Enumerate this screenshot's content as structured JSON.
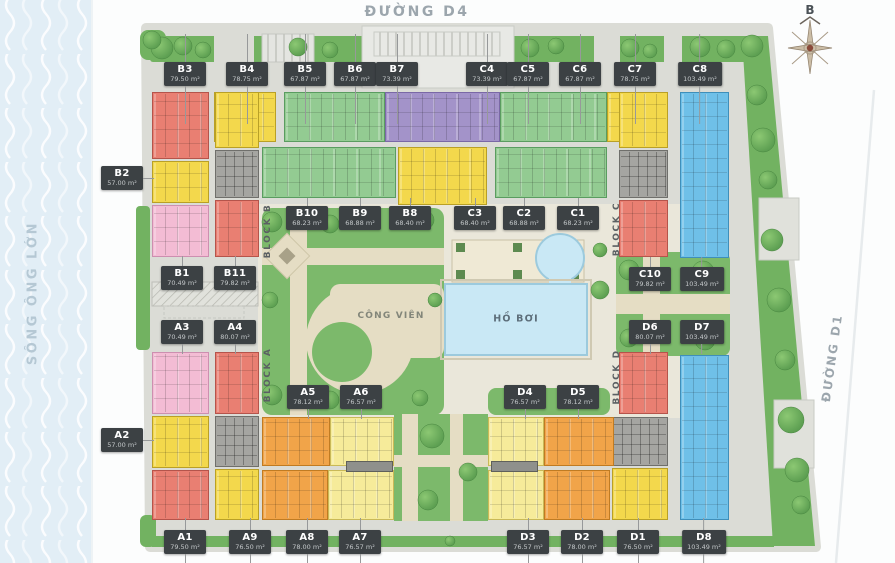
{
  "streets": {
    "top": "ĐƯỜNG D4",
    "right": "ĐƯỜNG D1"
  },
  "river": {
    "name": "SÔNG ÔNG LỚN"
  },
  "compass": {
    "north_label": "B"
  },
  "amenities": {
    "park": "CÔNG VIÊN",
    "pool": "HỒ BƠI"
  },
  "colors": {
    "site": "#dbdcd6",
    "landscape": "#72b261",
    "park": "#7cb96b",
    "pool_water": "#c9e8f5",
    "river": "#e2eef6",
    "label_bg": "#3c4144",
    "unit_red": "#e97f72",
    "unit_yellow": "#f3d84c",
    "unit_pink": "#f3bcd4",
    "unit_green": "#93cb92",
    "unit_purple": "#a393c9",
    "unit_cyan": "#6fc0e8",
    "unit_orange": "#f1a449",
    "unit_light_yellow": "#f6eb9a"
  },
  "blocks": [
    {
      "label": "BLOCK B",
      "x": 268,
      "y": 231
    },
    {
      "label": "BLOCK A",
      "x": 268,
      "y": 375
    },
    {
      "label": "BLOCK C",
      "x": 617,
      "y": 229
    },
    {
      "label": "BLOCK D",
      "x": 617,
      "y": 377
    }
  ],
  "units": [
    {
      "code": "B3",
      "area": "79.50 m²",
      "x": 185,
      "y": 62,
      "dir": "up",
      "len": 28,
      "len2": 38
    },
    {
      "code": "B4",
      "area": "78.75 m²",
      "x": 247,
      "y": 62,
      "dir": "up",
      "len": 28,
      "len2": 38
    },
    {
      "code": "B5",
      "area": "67.87 m²",
      "x": 305,
      "y": 62,
      "dir": "up",
      "len": 28,
      "len2": 38
    },
    {
      "code": "B6",
      "area": "67.87 m²",
      "x": 355,
      "y": 62,
      "dir": "up",
      "len": 28,
      "len2": 38
    },
    {
      "code": "B7",
      "area": "73.39 m²",
      "x": 397,
      "y": 62,
      "dir": "up",
      "len": 28,
      "len2": 38
    },
    {
      "code": "C4",
      "area": "73.39 m²",
      "x": 487,
      "y": 62,
      "dir": "up",
      "len": 28,
      "len2": 38
    },
    {
      "code": "C5",
      "area": "67.87 m²",
      "x": 528,
      "y": 62,
      "dir": "up",
      "len": 28,
      "len2": 38
    },
    {
      "code": "C6",
      "area": "67.87 m²",
      "x": 580,
      "y": 62,
      "dir": "up",
      "len": 28,
      "len2": 38
    },
    {
      "code": "C7",
      "area": "78.75 m²",
      "x": 635,
      "y": 62,
      "dir": "up",
      "len": 28,
      "len2": 38
    },
    {
      "code": "C8",
      "area": "103.49 m²",
      "x": 700,
      "y": 62,
      "dir": "up",
      "len": 28,
      "len2": 38
    },
    {
      "code": "B2",
      "area": "57.00 m²",
      "x": 122,
      "y": 166,
      "dir": "right",
      "len": 11
    },
    {
      "code": "B10",
      "area": "68.23 m²",
      "x": 307,
      "y": 206,
      "dir": "up",
      "len": 8
    },
    {
      "code": "B9",
      "area": "68.88 m²",
      "x": 360,
      "y": 206,
      "dir": "up",
      "len": 8
    },
    {
      "code": "B8",
      "area": "68.40 m²",
      "x": 410,
      "y": 206,
      "dir": "up",
      "len": 8
    },
    {
      "code": "C3",
      "area": "68.40 m²",
      "x": 475,
      "y": 206,
      "dir": "up",
      "len": 8
    },
    {
      "code": "C2",
      "area": "68.88 m²",
      "x": 524,
      "y": 206,
      "dir": "up",
      "len": 8
    },
    {
      "code": "C1",
      "area": "68.23 m²",
      "x": 578,
      "y": 206,
      "dir": "up",
      "len": 8
    },
    {
      "code": "B1",
      "area": "70.49 m²",
      "x": 182,
      "y": 266,
      "dir": "up",
      "len": 10
    },
    {
      "code": "B11",
      "area": "79.82 m²",
      "x": 235,
      "y": 266,
      "dir": "up",
      "len": 10
    },
    {
      "code": "C10",
      "area": "79.82 m²",
      "x": 650,
      "y": 267,
      "dir": "up",
      "len": 10
    },
    {
      "code": "C9",
      "area": "103.49 m²",
      "x": 702,
      "y": 267,
      "dir": "up",
      "len": 10
    },
    {
      "code": "A3",
      "area": "70.49 m²",
      "x": 182,
      "y": 320,
      "dir": "down",
      "len": 10
    },
    {
      "code": "A4",
      "area": "80.07 m²",
      "x": 235,
      "y": 320,
      "dir": "down",
      "len": 10
    },
    {
      "code": "D6",
      "area": "80.07 m²",
      "x": 650,
      "y": 320,
      "dir": "down",
      "len": 10
    },
    {
      "code": "D7",
      "area": "103.49 m²",
      "x": 702,
      "y": 320,
      "dir": "down",
      "len": 10
    },
    {
      "code": "A5",
      "area": "78.12 m²",
      "x": 308,
      "y": 385,
      "dir": "down",
      "len": 10
    },
    {
      "code": "A6",
      "area": "76.57 m²",
      "x": 361,
      "y": 385,
      "dir": "down",
      "len": 10
    },
    {
      "code": "D4",
      "area": "76.57 m²",
      "x": 525,
      "y": 385,
      "dir": "down",
      "len": 10
    },
    {
      "code": "D5",
      "area": "78.12 m²",
      "x": 578,
      "y": 385,
      "dir": "down",
      "len": 10
    },
    {
      "code": "A2",
      "area": "57.00 m²",
      "x": 122,
      "y": 428,
      "dir": "right",
      "len": 11
    },
    {
      "code": "A1",
      "area": "79.50 m²",
      "x": 185,
      "y": 530,
      "dir": "up",
      "len": 12,
      "len2": 14
    },
    {
      "code": "A9",
      "area": "76.50 m²",
      "x": 250,
      "y": 530,
      "dir": "up",
      "len": 12,
      "len2": 14
    },
    {
      "code": "A8",
      "area": "78.00 m²",
      "x": 307,
      "y": 530,
      "dir": "up",
      "len": 12,
      "len2": 14
    },
    {
      "code": "A7",
      "area": "76.57 m²",
      "x": 360,
      "y": 530,
      "dir": "up",
      "len": 12,
      "len2": 14
    },
    {
      "code": "D3",
      "area": "76.57 m²",
      "x": 528,
      "y": 530,
      "dir": "up",
      "len": 12,
      "len2": 14
    },
    {
      "code": "D2",
      "area": "78.00 m²",
      "x": 582,
      "y": 530,
      "dir": "up",
      "len": 12,
      "len2": 14
    },
    {
      "code": "D1",
      "area": "76.50 m²",
      "x": 638,
      "y": 530,
      "dir": "up",
      "len": 12,
      "len2": 14
    },
    {
      "code": "D8",
      "area": "103.49 m²",
      "x": 704,
      "y": 530,
      "dir": "up",
      "len": 12,
      "len2": 14
    }
  ]
}
